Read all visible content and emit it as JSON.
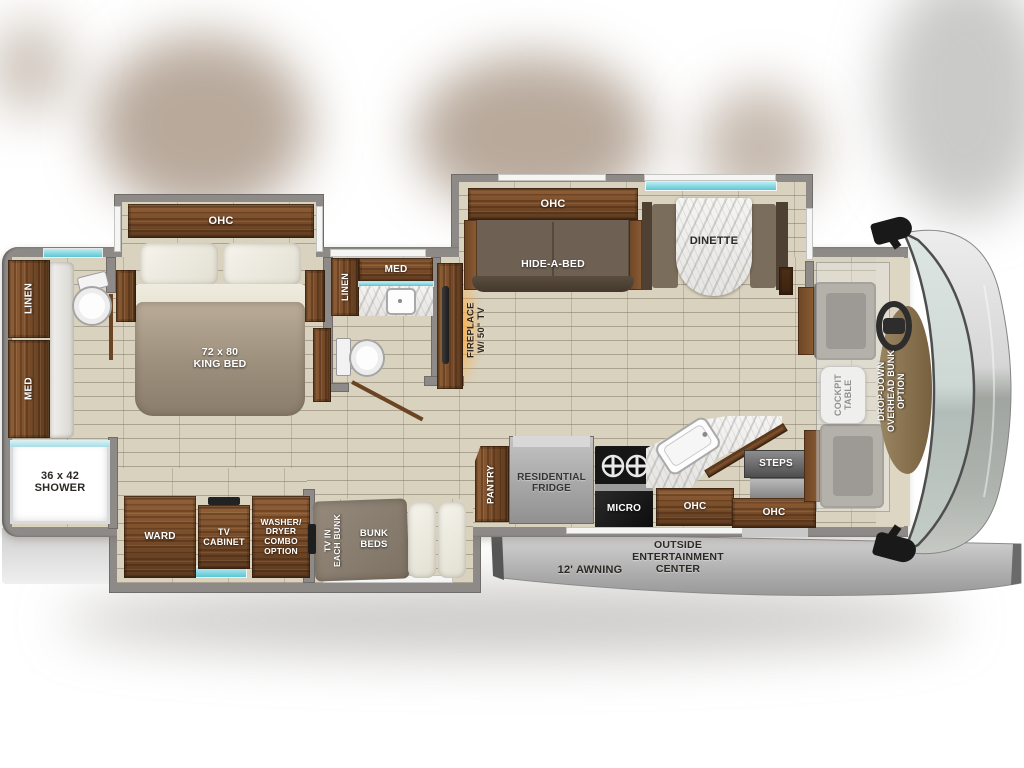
{
  "labels": {
    "rear_bath": {
      "linen": "LINEN",
      "med": "MED",
      "shower": "36 x 42\nSHOWER"
    },
    "bedroom": {
      "ohc": "OHC",
      "king_bed": "72 x 80\nKING BED",
      "ward": "WARD",
      "tv_cabinet": "TV\nCABINET",
      "washer_dryer": "WASHER/\nDRYER\nCOMBO\nOPTION"
    },
    "bunk_room": {
      "tv_in_each_bunk": "TV IN\nEACH BUNK",
      "bunk_beds": "BUNK\nBEDS"
    },
    "mid_bath": {
      "med": "MED",
      "linen": "LINEN"
    },
    "living": {
      "fireplace": "FIREPLACE\nW/ 50\" TV",
      "ohc": "OHC",
      "hide_a_bed": "HIDE-A-BED",
      "dinette": "DINETTE"
    },
    "kitchen": {
      "pantry": "PANTRY",
      "fridge": "RESIDENTIAL\nFRIDGE",
      "micro": "MICRO",
      "ohc": "OHC"
    },
    "entry": {
      "steps": "STEPS",
      "ohc": "OHC"
    },
    "cockpit": {
      "table": "COCKPIT\nTABLE",
      "drop_down": "DROP-DOWN\nOVERHEAD BUNK\nOPTION"
    },
    "exterior": {
      "entertainment": "OUTSIDE\nENTERTAINMENT\nCENTER",
      "awning": "12' AWNING"
    }
  },
  "colors": {
    "wood": "#7a4d2a",
    "wall_gray": "#8d8a87",
    "floor_beige": "#d9d2bf",
    "accent_teal": "#5cc6d4",
    "fireplace_glow": "#ffaa3c",
    "awning_gray": "#b9b9b9"
  }
}
